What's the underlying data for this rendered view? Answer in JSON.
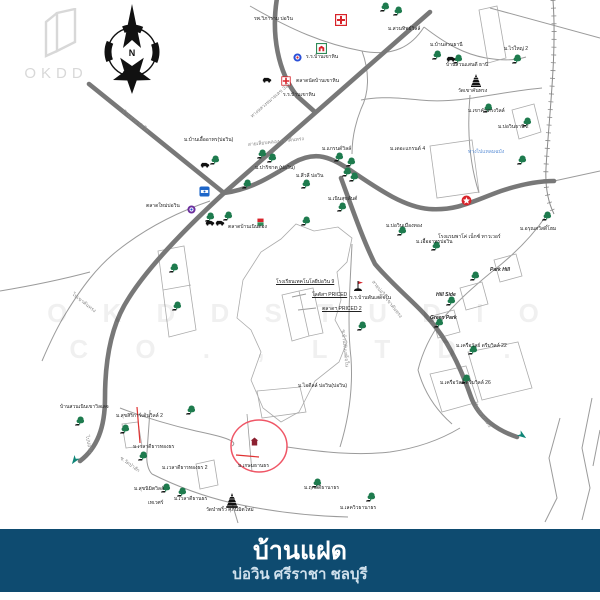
{
  "logo": {
    "text": "OKDD"
  },
  "compass": {
    "label": "N"
  },
  "watermark": {
    "line1": "O K D D   S T U D I O",
    "line2": "C O . ,  L T D ."
  },
  "footer": {
    "title": "บ้านแฝด",
    "subtitle": "บ่อวิน ศรีราชา ชลบุรี",
    "bg": "#0e4b70"
  },
  "colors": {
    "road": "#787878",
    "thin_road": "#9b9b9b",
    "accent_red": "#ef5666",
    "tree_green": "#1e7b4e",
    "navy": "#0e4b70",
    "hospital_red": "#d8232a"
  },
  "map": {
    "trees": [
      [
        384,
        7
      ],
      [
        397,
        11
      ],
      [
        436,
        55
      ],
      [
        457,
        59
      ],
      [
        516,
        59
      ],
      [
        487,
        108
      ],
      [
        526,
        122
      ],
      [
        214,
        160
      ],
      [
        246,
        184
      ],
      [
        209,
        217
      ],
      [
        227,
        216
      ],
      [
        261,
        154
      ],
      [
        271,
        158
      ],
      [
        338,
        157
      ],
      [
        350,
        162
      ],
      [
        346,
        172
      ],
      [
        353,
        177
      ],
      [
        305,
        184
      ],
      [
        341,
        207
      ],
      [
        305,
        221
      ],
      [
        401,
        231
      ],
      [
        435,
        246
      ],
      [
        546,
        216
      ],
      [
        521,
        160
      ],
      [
        173,
        268
      ],
      [
        176,
        306
      ],
      [
        361,
        326
      ],
      [
        474,
        276
      ],
      [
        450,
        301
      ],
      [
        438,
        323
      ],
      [
        472,
        350
      ],
      [
        465,
        379
      ],
      [
        79,
        421
      ],
      [
        124,
        429
      ],
      [
        142,
        456
      ],
      [
        190,
        410
      ],
      [
        165,
        488
      ],
      [
        181,
        492
      ],
      [
        316,
        483
      ],
      [
        370,
        497
      ]
    ],
    "icons": [
      {
        "type": "hospital-cross",
        "x": 341,
        "y": 20
      },
      {
        "type": "hospital-cross",
        "x": 286,
        "y": 81,
        "s": 0.8
      },
      {
        "type": "green-box",
        "x": 322,
        "y": 49
      },
      {
        "type": "blue-donut",
        "x": 299,
        "y": 59
      },
      {
        "type": "purple-donut",
        "x": 193,
        "y": 211
      },
      {
        "type": "ptt",
        "x": 205,
        "y": 192
      },
      {
        "type": "star-circle",
        "x": 467,
        "y": 201
      },
      {
        "type": "temple",
        "x": 476,
        "y": 80
      },
      {
        "type": "temple",
        "x": 232,
        "y": 500,
        "s": 1.15
      },
      {
        "type": "car",
        "x": 452,
        "y": 62
      },
      {
        "type": "car",
        "x": 206,
        "y": 168
      },
      {
        "type": "car",
        "x": 268,
        "y": 83
      },
      {
        "type": "car",
        "x": 211,
        "y": 226
      },
      {
        "type": "car",
        "x": 221,
        "y": 226
      },
      {
        "type": "shop-flag",
        "x": 263,
        "y": 224
      },
      {
        "type": "lotus-flag",
        "x": 358,
        "y": 286
      },
      {
        "type": "site-home",
        "x": 256,
        "y": 443
      },
      {
        "type": "arrow-teal",
        "x": 76,
        "y": 462,
        "r": 35
      },
      {
        "type": "arrow-teal",
        "x": 524,
        "y": 437,
        "r": -55
      }
    ],
    "labels": [
      {
        "t": "รพ.วิภาราม บ่อวิน",
        "x": 254,
        "y": 20
      },
      {
        "t": "ม.สวนทิพย์วิลล์",
        "x": 388,
        "y": 30
      },
      {
        "t": "ร.ร.บ้านเขาหิน",
        "x": 306,
        "y": 58
      },
      {
        "t": "ตลาดนัดบ้านเขาหิน",
        "x": 296,
        "y": 82
      },
      {
        "t": "ร.ร.บ้านเขาหิน",
        "x": 283,
        "y": 96
      },
      {
        "t": "ม.บ้านสวนธานี",
        "x": 430,
        "y": 46
      },
      {
        "t": "บ้านสวนแสนดี ธานี",
        "x": 446,
        "y": 66
      },
      {
        "t": "ม.ไร่ใหญ่ 2",
        "x": 504,
        "y": 50
      },
      {
        "t": "วัดเขาคันทรง",
        "x": 458,
        "y": 92
      },
      {
        "t": "ม.เขาคันทรงวิลล์",
        "x": 468,
        "y": 112
      },
      {
        "t": "ม.บ่อวินธานี 2",
        "x": 498,
        "y": 128
      },
      {
        "t": "ม.บ้านเอื้ออาทร(บ่อวิน)",
        "x": 184,
        "y": 141
      },
      {
        "t": "ม.แกรนด์วิลล์",
        "x": 322,
        "y": 150
      },
      {
        "t": "ม.เดอะแกรนด์ 4",
        "x": 390,
        "y": 150
      },
      {
        "t": "ม.ปาริชาต (บ่อวิน)",
        "x": 255,
        "y": 169
      },
      {
        "t": "ม.สีวลี บ่อวิน",
        "x": 296,
        "y": 177
      },
      {
        "t": "ม.เนินสุขสันต์",
        "x": 328,
        "y": 200
      },
      {
        "t": "ม.บ่อวินเมืองทอง",
        "x": 386,
        "y": 227
      },
      {
        "t": "ม.เอื้ออาทรบ่อวิน",
        "x": 416,
        "y": 243
      },
      {
        "t": "ม.อรุณสวัสดิ์โฮม",
        "x": 520,
        "y": 230
      },
      {
        "t": "โรงแรมพาโค่ เน็กซ์ ทาวเวอร์",
        "x": 438,
        "y": 238
      },
      {
        "t": "ตลาดใหม่บ่อวิน",
        "x": 146,
        "y": 207
      },
      {
        "t": "ตลาดบ้านเนินตอง",
        "x": 228,
        "y": 228
      },
      {
        "t": "โรงเรียนเทคโนโลยีบ่อวิน 9",
        "x": 276,
        "y": 283,
        "u": 1
      },
      {
        "t": "โลตัสฯ PRICED",
        "x": 312,
        "y": 296,
        "u": 1
      },
      {
        "t": "ตลาดฯ PRICED 2",
        "x": 322,
        "y": 310,
        "u": 1
      },
      {
        "t": "ร.ร.บ้านพันเสด็จใน",
        "x": 350,
        "y": 299
      },
      {
        "t": "Park Hill",
        "x": 490,
        "y": 271,
        "b": 1
      },
      {
        "t": "Hill Side",
        "x": 436,
        "y": 296,
        "b": 1
      },
      {
        "t": "Green Park",
        "x": 430,
        "y": 319,
        "b": 1
      },
      {
        "t": "ม.เครือวัลย์ ดรีมวิลล์ 22",
        "x": 456,
        "y": 347
      },
      {
        "t": "ม.เครือวัลย์ ดรีมวิลล์ 26",
        "x": 440,
        "y": 384
      },
      {
        "t": "ม.ไอดีลล์ บ่อวิน(บ่อวิน)",
        "x": 298,
        "y": 387
      },
      {
        "t": "บ้านสวนเนินเขาวิลเลจ",
        "x": 60,
        "y": 408
      },
      {
        "t": "ม.สุขสิริการ์เด้นวิลล์ 2",
        "x": 116,
        "y": 417
      },
      {
        "t": "ม.เวลาดีธารทองธร",
        "x": 133,
        "y": 448
      },
      {
        "t": "ม.เวลาดีธารทองธร 2",
        "x": 162,
        "y": 469
      },
      {
        "t": "ม.เกษมธานธร",
        "x": 238,
        "y": 467
      },
      {
        "t": "ม.สุขนิมิตวิลล์",
        "x": 134,
        "y": 490
      },
      {
        "t": "เทเวศร์",
        "x": 148,
        "y": 504
      },
      {
        "t": "ม.เวลาดีธานธร",
        "x": 174,
        "y": 500
      },
      {
        "t": "วัดป่าพริ้ว ศุภนิมิตใหม่",
        "x": 206,
        "y": 511
      },
      {
        "t": "ม.ฤกษ์ดีธานาธร",
        "x": 304,
        "y": 489
      },
      {
        "t": "ม.เลควิวธานาธร",
        "x": 340,
        "y": 509
      },
      {
        "t": "บ้านสวน-บ่อวิน",
        "x": 122,
        "y": 112,
        "r": 38,
        "c": "#8a8a8a"
      },
      {
        "t": "ทางหลวงหมายเลข 331",
        "x": 252,
        "y": 118,
        "r": -41,
        "c": "#8a8a8a"
      },
      {
        "t": "สายเลียบคลอง-เขาคันทรง",
        "x": 248,
        "y": 146,
        "r": -6,
        "c": "#8a8a8a"
      },
      {
        "t": "สายบ่อวิน-เขาคันทรง",
        "x": 372,
        "y": 282,
        "r": 52,
        "c": "#8a8a8a"
      },
      {
        "t": "ไปปลวกแดง",
        "x": 474,
        "y": 406,
        "r": 55,
        "c": "#8a8a8a"
      },
      {
        "t": "ไปบ่อวิน",
        "x": 86,
        "y": 436,
        "r": 78,
        "c": "#8a8a8a"
      },
      {
        "t": "ไปเขาคันทรง",
        "x": 72,
        "y": 295,
        "r": 38,
        "c": "#8a8a8a"
      },
      {
        "t": "ซ.บ้านพันเสด็จใน",
        "x": 342,
        "y": 330,
        "r": 84,
        "c": "#8a8a8a"
      },
      {
        "t": "ซ.วัดป่าสัก",
        "x": 120,
        "y": 459,
        "r": 36,
        "c": "#8a8a8a"
      },
      {
        "t": "ทางไปแหลมฉบัง",
        "x": 468,
        "y": 153,
        "c": "#5b8fd6"
      }
    ]
  }
}
